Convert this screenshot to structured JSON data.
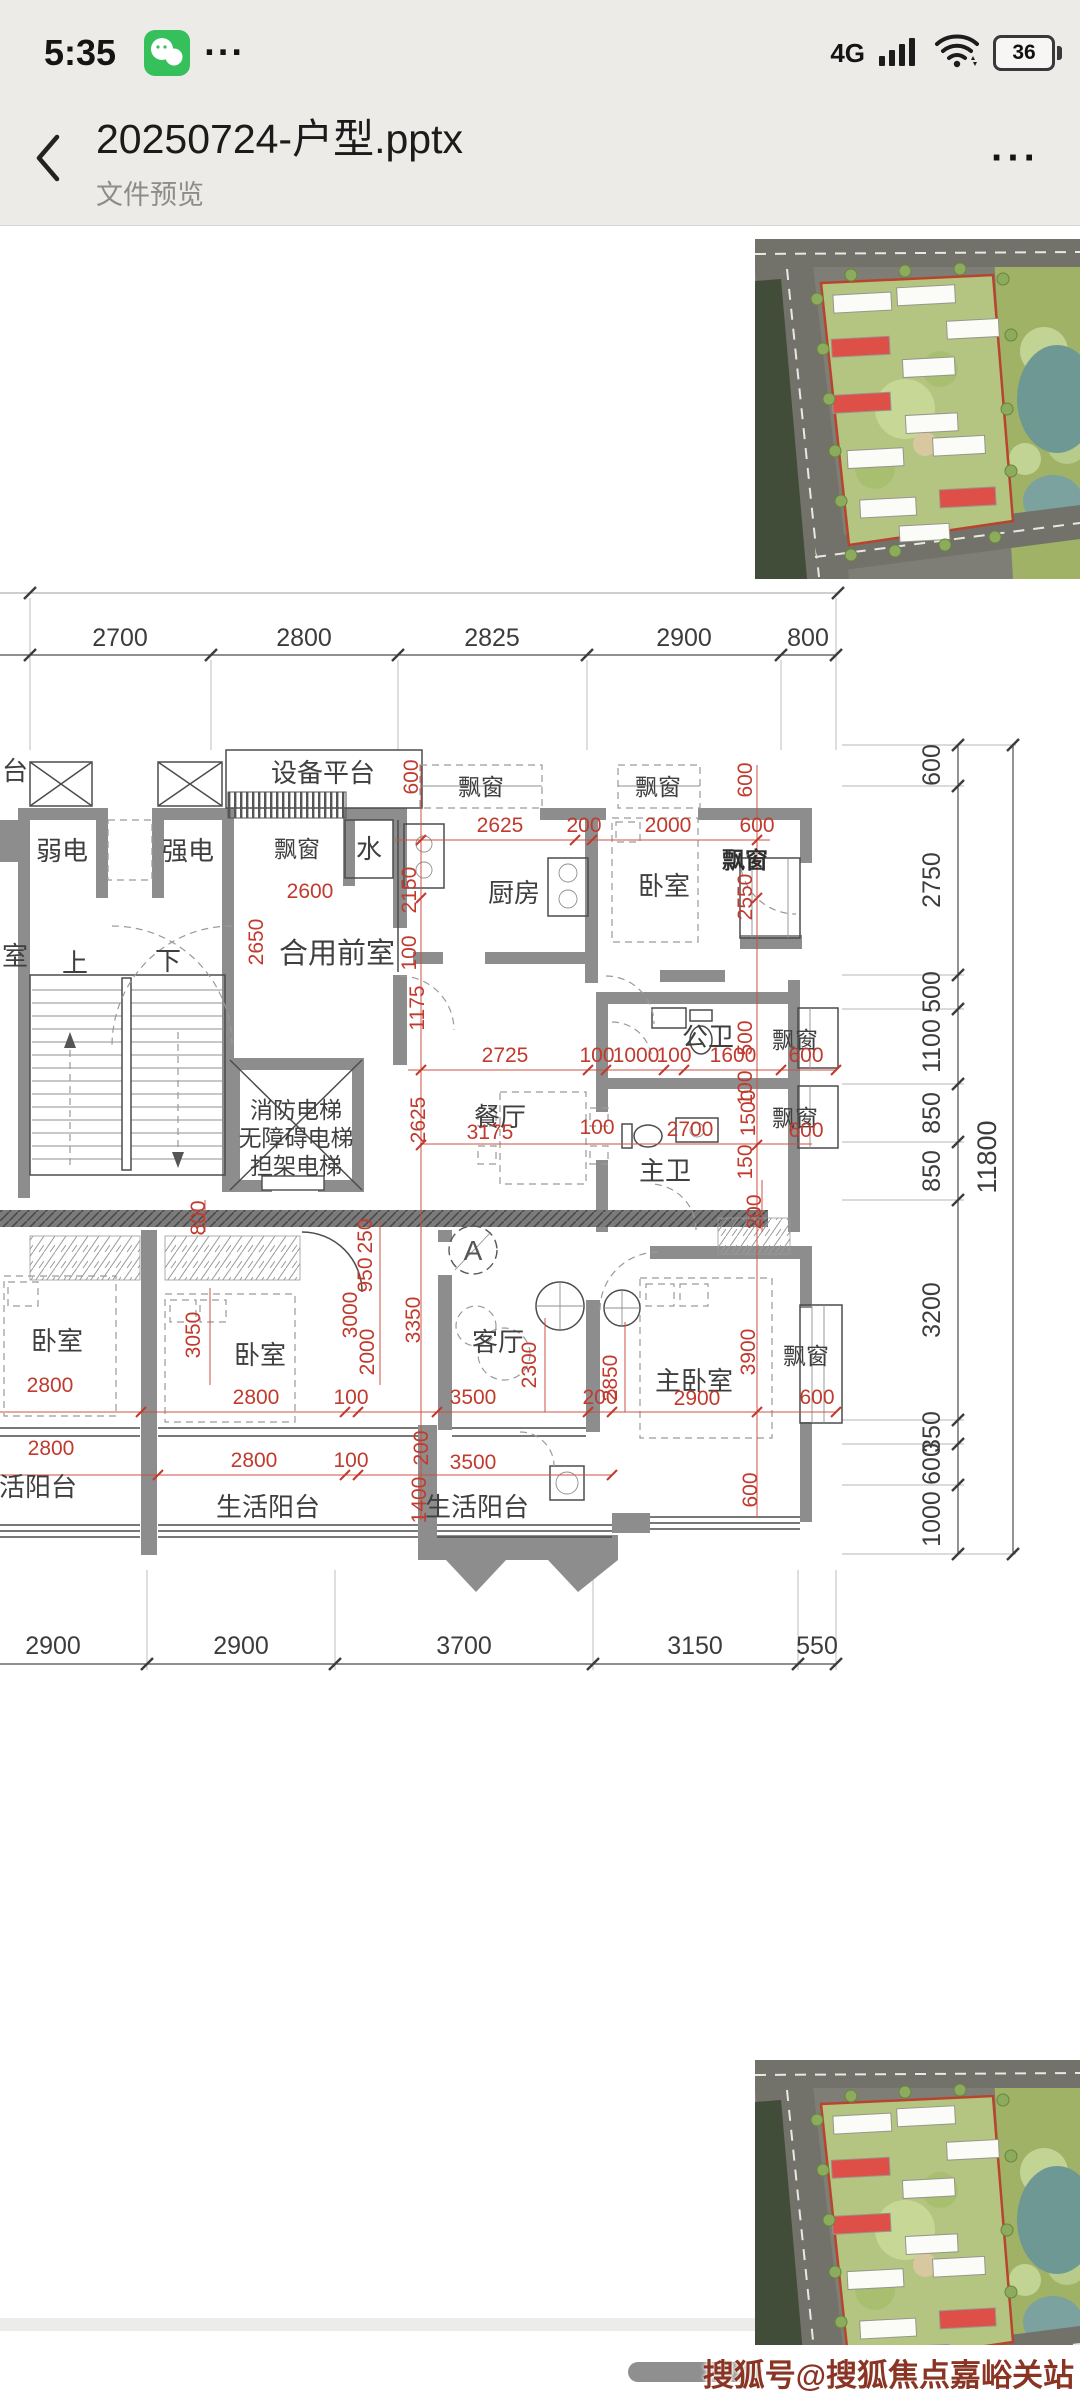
{
  "status_bar": {
    "time": "5:35",
    "more": "···",
    "network": "4G",
    "battery": "36"
  },
  "header": {
    "title": "20250724-户型.pptx",
    "subtitle": "文件预览",
    "menu": "···"
  },
  "floor_plan": {
    "dims_top": [
      "2700",
      "2800",
      "2825",
      "2900",
      "800"
    ],
    "dims_bottom": [
      "2900",
      "2900",
      "3700",
      "3150",
      "550"
    ],
    "dims_right": [
      "600",
      "2750",
      "500",
      "1100",
      "850",
      "850",
      "3200",
      "350",
      "600",
      "1000"
    ],
    "dims_right_total": "11800",
    "rooms": {
      "equipment_platform": "设备平台",
      "platform_partial": "台",
      "room_partial": "室",
      "weak_electric": "弱电",
      "strong_electric": "强电",
      "bay_window": "飘窗",
      "water": "水",
      "kitchen": "厨房",
      "bedroom": "卧室",
      "shared_front_room": "合用前室",
      "up": "上",
      "down": "下",
      "elevator_1": "消防电梯",
      "elevator_2": "无障碍电梯",
      "elevator_3": "担架电梯",
      "public_bath": "公卫",
      "dining": "餐厅",
      "master_bath": "主卫",
      "living": "客厅",
      "master_bedroom": "主卧室",
      "balcony": "生活阳台",
      "section_a": "A"
    },
    "red_dims": [
      "600",
      "2625",
      "200",
      "2000",
      "600",
      "600",
      "2550",
      "2600",
      "2650",
      "2150",
      "100",
      "1175",
      "2725",
      "100",
      "1000",
      "100",
      "1600",
      "500",
      "600",
      "2625",
      "3175",
      "100",
      "2700",
      "1500",
      "600",
      "100",
      "200",
      "800",
      "250",
      "950",
      "150",
      "3350",
      "3000",
      "3050",
      "2000",
      "2800",
      "2800",
      "100",
      "2300",
      "3500",
      "200",
      "2850",
      "3900",
      "2900",
      "600",
      "2800",
      "2800",
      "100",
      "3500",
      "1400",
      "200",
      "600"
    ]
  },
  "watermark": "搜狐号@搜狐焦点嘉峪关站"
}
